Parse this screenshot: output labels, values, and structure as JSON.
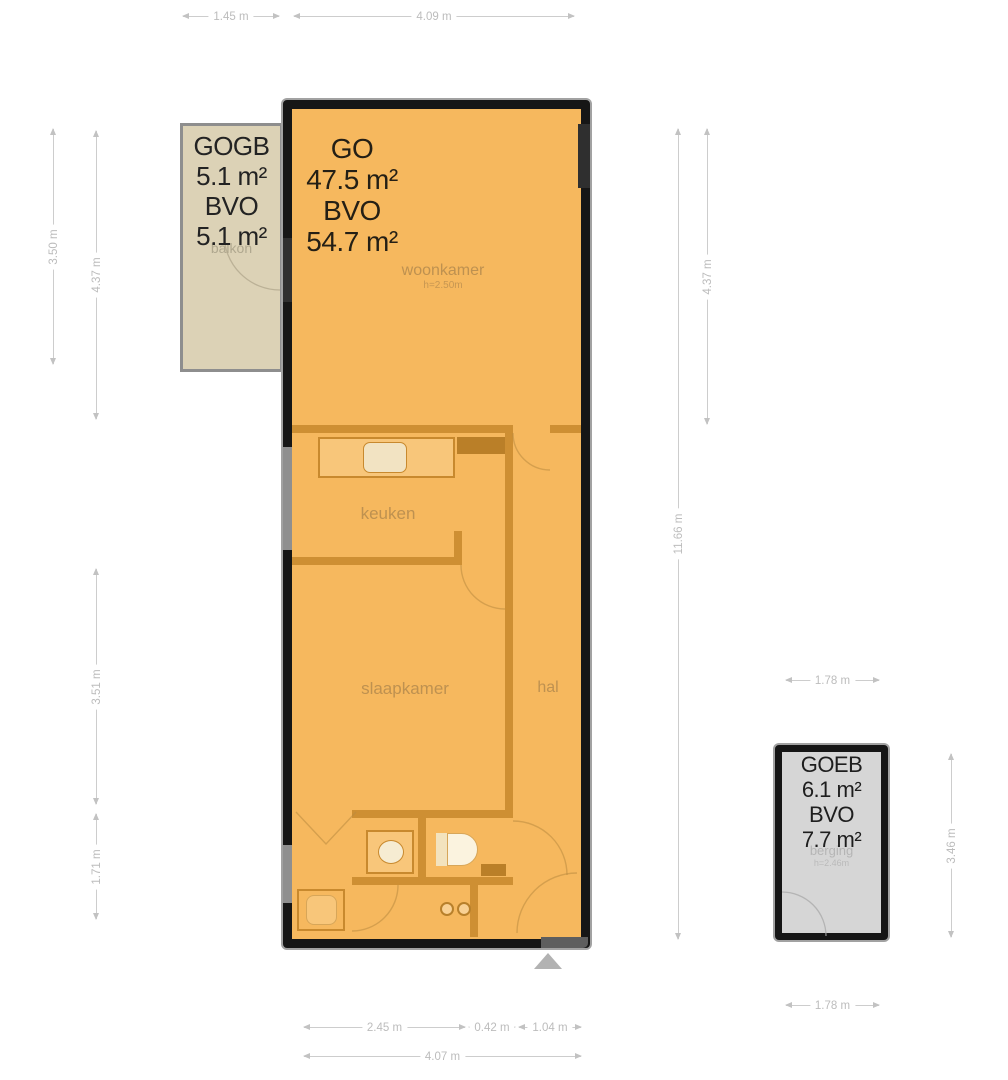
{
  "plan": {
    "main_unit": {
      "go_label": "GO",
      "go_area": "47.5 m²",
      "bvo_label": "BVO",
      "bvo_area": "54.7 m²",
      "rooms": {
        "woonkamer": {
          "name": "woonkamer",
          "ceiling": "h=2.50m"
        },
        "keuken": {
          "name": "keuken"
        },
        "slaapkamer": {
          "name": "slaapkamer"
        },
        "hal": {
          "name": "hal"
        }
      }
    },
    "balcony_unit": {
      "gogb_label": "GOGB",
      "gogb_area": "5.1 m²",
      "bvo_label": "BVO",
      "bvo_area": "5.1 m²",
      "room_name": "balkon"
    },
    "storage_unit": {
      "goeb_label": "GOEB",
      "goeb_area": "6.1 m²",
      "bvo_label": "BVO",
      "bvo_area": "7.7 m²",
      "room_name": "berging",
      "ceiling": "h=2.46m"
    }
  },
  "dims": {
    "top_left": "1.45 m",
    "top_main": "4.09 m",
    "left_balcony": "3.50 m",
    "left_upper": "4.37 m",
    "left_mid": "3.51 m",
    "left_lower": "1.71 m",
    "right_total": "11.66 m",
    "right_upper": "4.37 m",
    "bottom_seg1": "2.45 m",
    "bottom_seg2": "0.42 m",
    "bottom_seg3": "1.04 m",
    "bottom_total": "4.07 m",
    "storage_top": "1.78 m",
    "storage_right": "3.46 m",
    "storage_bottom": "1.78 m"
  },
  "colors": {
    "floor": "#F6B85E",
    "interior_wall": "#CE8F33",
    "outer_wall": "#161616",
    "balcony_fill": "#DCD2B6",
    "storage_fill": "#D6D6D6",
    "dimension": "#C6C6C6"
  }
}
